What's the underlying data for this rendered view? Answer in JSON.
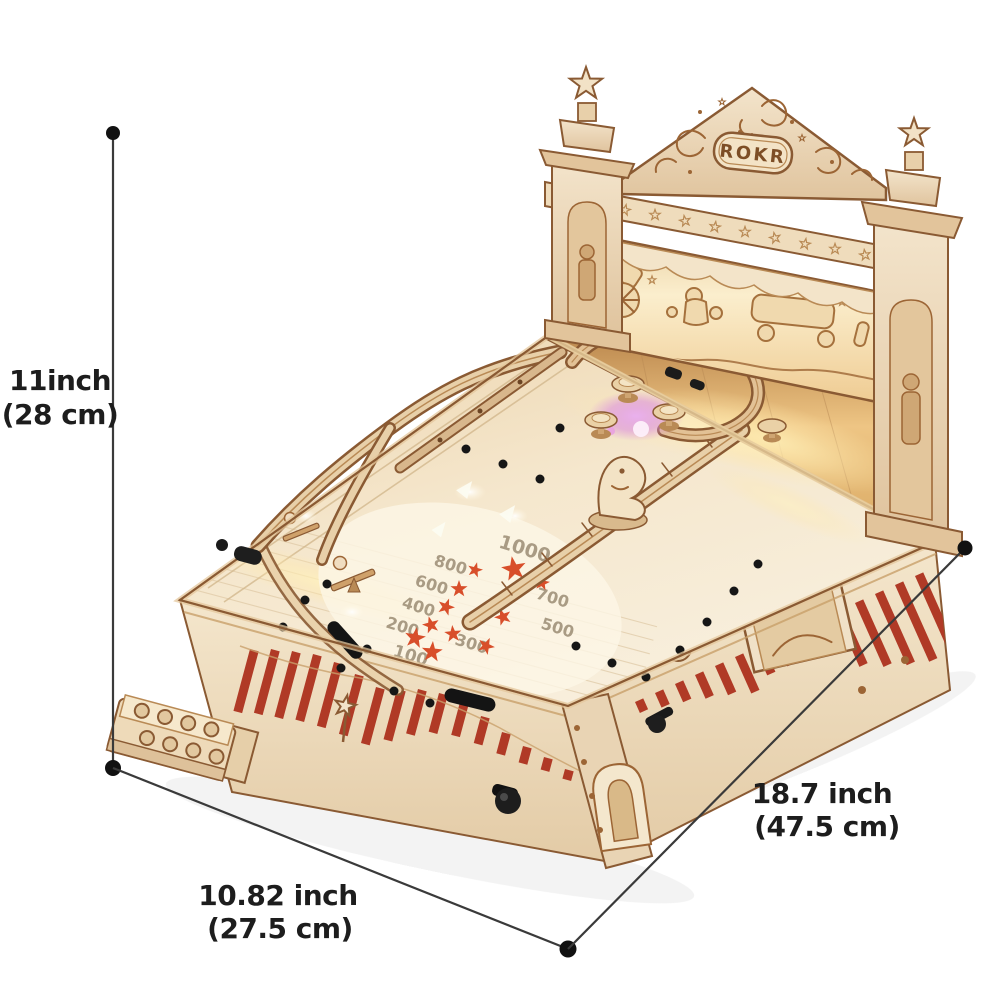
{
  "branding": {
    "logo_text": "ROKR"
  },
  "annotations": {
    "height": {
      "primary": "11inch",
      "secondary": "(28 cm)"
    },
    "width": {
      "primary": "10.82 inch",
      "secondary": "(27.5 cm)"
    },
    "length": {
      "primary": "18.7 inch",
      "secondary": "(47.5 cm)"
    }
  },
  "playfield_scores": [
    "1000",
    "800",
    "600",
    "400",
    "200",
    "100",
    "300",
    "500",
    "700"
  ],
  "colors": {
    "wood_light": "#f2e3c9",
    "wood_mid": "#d9b98c",
    "wood_dark": "#8a5a33",
    "stripe_red": "#b03a26",
    "star_red": "#d84e2a",
    "glow_warm": "#ffe9ae",
    "glow_purple": "#d98ae2",
    "annotation_line": "#3a3a3a",
    "annotation_text": "#1d1d1d"
  }
}
